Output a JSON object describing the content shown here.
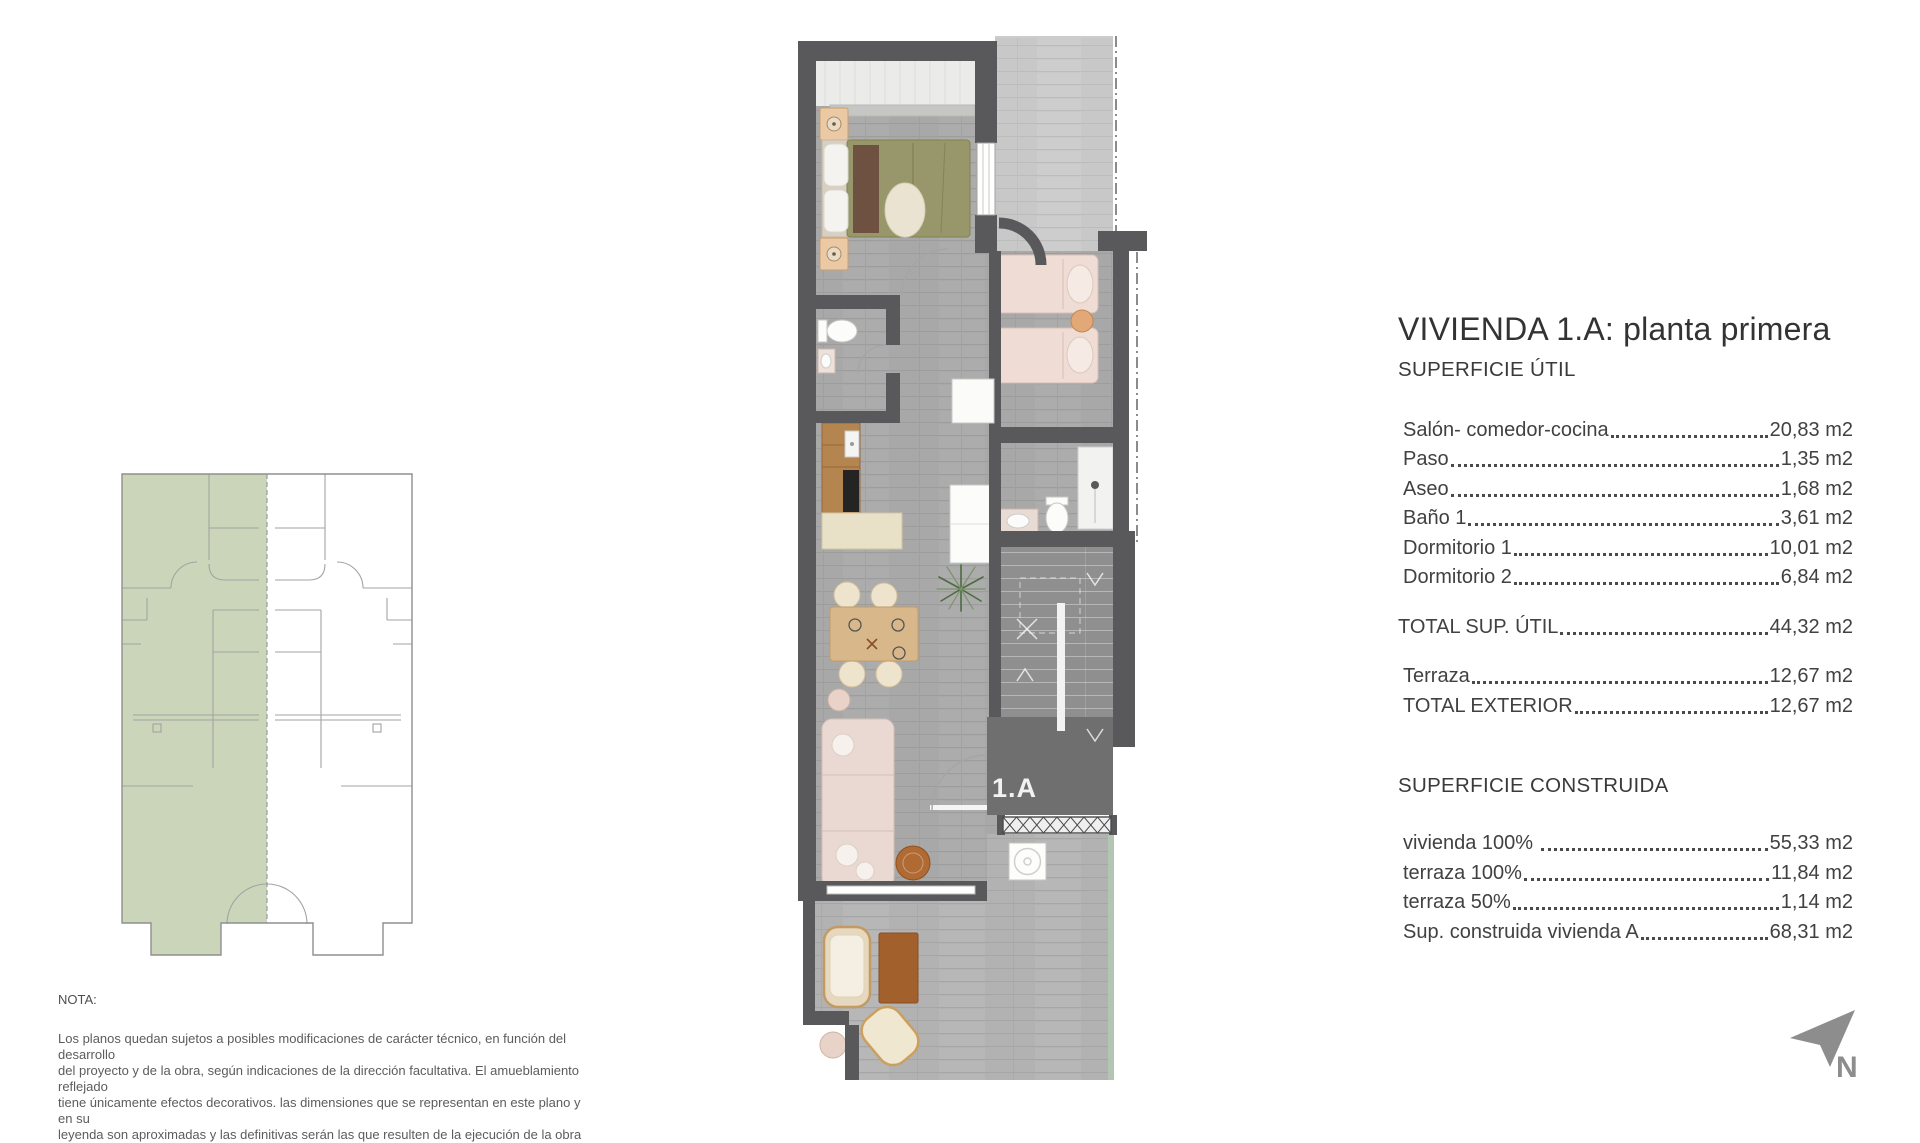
{
  "title": "VIVIENDA 1.A: planta primera",
  "superficie_util": {
    "heading": "SUPERFICIE ÚTIL",
    "rows": [
      {
        "label": "Salón- comedor-cocina",
        "value": "20,83 m2"
      },
      {
        "label": "Paso",
        "value": "1,35 m2"
      },
      {
        "label": "Aseo",
        "value": "1,68 m2"
      },
      {
        "label": "Baño 1",
        "value": "3,61 m2"
      },
      {
        "label": "Dormitorio 1",
        "value": "10,01 m2"
      },
      {
        "label": "Dormitorio 2",
        "value": "6,84 m2"
      }
    ],
    "total": {
      "label": "TOTAL SUP. ÚTIL",
      "value": "44,32 m2"
    },
    "exterior_rows": [
      {
        "label": "Terraza",
        "value": "12,67 m2"
      },
      {
        "label": "TOTAL EXTERIOR",
        "value": "12,67 m2"
      }
    ]
  },
  "superficie_construida": {
    "heading": "SUPERFICIE CONSTRUIDA",
    "rows": [
      {
        "label": "vivienda 100% ",
        "value": "55,33 m2"
      },
      {
        "label": "terraza 100%",
        "value": "11,84 m2"
      },
      {
        "label": "terraza 50%",
        "value": "1,14 m2"
      },
      {
        "label": "Sup. construida vivienda A",
        "value": "68,31 m2"
      }
    ]
  },
  "nota": {
    "heading": "NOTA:",
    "lines": [
      "Los planos quedan sujetos a posibles modificaciones de carácter técnico, en función del desarrollo",
      "del proyecto y de la obra, según indicaciones de la dirección facultativa. El amueblamiento reflejado",
      "tiene únicamente efectos decorativos. las dimensiones que se representan en este plano y en su",
      "leyenda son aproximadas y las definitivas serán las que resulten de la ejecución de la obra"
    ]
  },
  "floor_plan": {
    "unit_label": "1.A"
  },
  "north_indicator": {
    "label": "N"
  },
  "colors": {
    "highlight_green": "#cbd5b9",
    "wall_gray": "#59585a"
  }
}
